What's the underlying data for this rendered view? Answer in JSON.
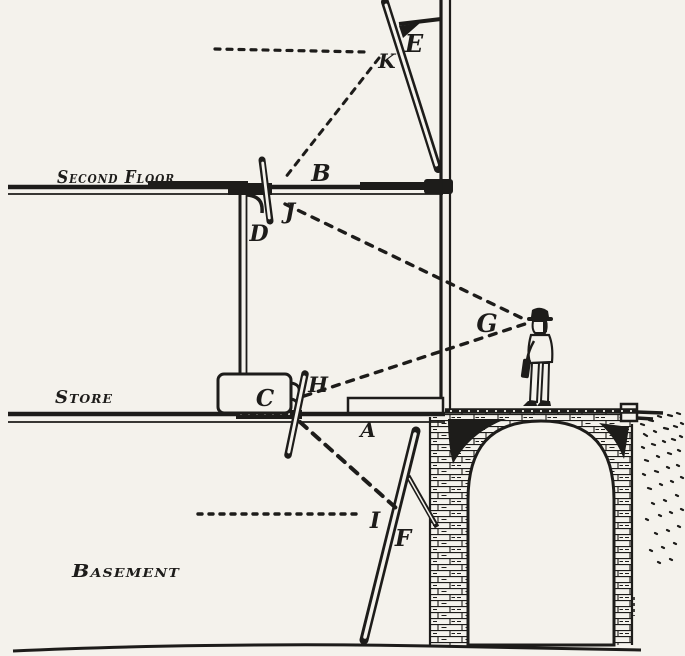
{
  "figure": {
    "paper_color": "#f4f2ec",
    "ink_color": "#1d1c1a"
  },
  "floor_labels": {
    "second_floor": "Second Floor",
    "store": "Store",
    "basement": "Basement"
  },
  "markers": {
    "A": "A",
    "B": "B",
    "C": "C",
    "D": "D",
    "E": "E",
    "F": "F",
    "G": "G",
    "H": "H",
    "I": "I",
    "J": "J",
    "K": "K"
  }
}
